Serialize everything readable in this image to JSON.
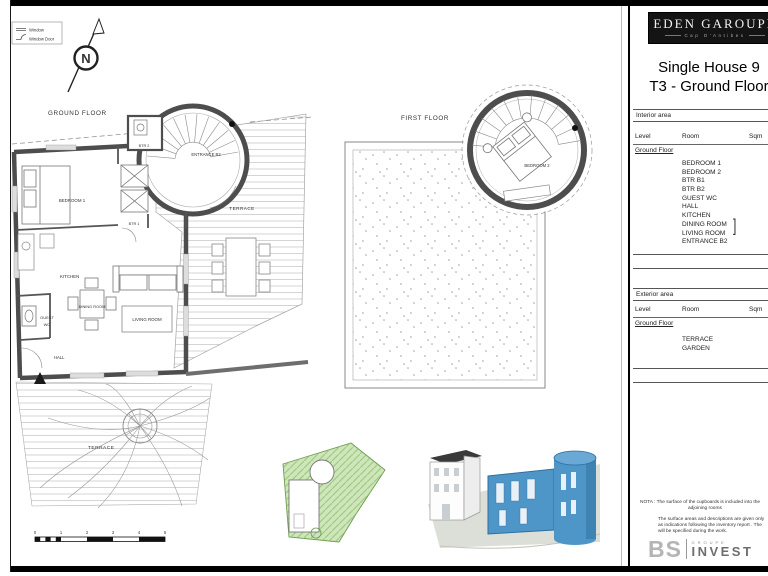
{
  "sheet": {
    "legend": {
      "window": "Window",
      "window_door": "Window Door"
    },
    "north_label": "N",
    "ground": {
      "title": "GROUND FLOOR",
      "rooms": {
        "bedroom1": "BEDROOM 1",
        "btr2": "BTR 2",
        "btr1": "BTR 1",
        "entrance_b2": "ENTRANCE B2",
        "kitchen": "KITCHEN",
        "dining": "DINING ROOM",
        "living": "LIVING ROOM",
        "guest_wc1": "GUEST",
        "guest_wc2": "WC",
        "hall": "HALL",
        "terrace_upper": "TERRACE",
        "terrace_lower": "TERRACE"
      }
    },
    "first": {
      "title": "FIRST FLOOR",
      "rooms": {
        "bedroom2": "BEDROOM 2"
      }
    },
    "scale_ticks": [
      "0",
      "1",
      "2",
      "3",
      "4",
      "5"
    ]
  },
  "panel": {
    "brand": {
      "name": "EDEN GAROUPE",
      "tagline": "Cap D'Antibes"
    },
    "title": {
      "line1": "Single House 9",
      "line2": "T3 - Ground Floor"
    },
    "interior": {
      "heading": "Interior area",
      "columns": {
        "level": "Level",
        "room": "Room",
        "sqm": "Sqm"
      },
      "level": "Ground Floor",
      "rows": [
        {
          "room": "BEDROOM 1",
          "sqm": "14.25 m²"
        },
        {
          "room": "BEDROOM 2",
          "sqm": "12.15 m²"
        },
        {
          "room": "BTR B1",
          "sqm": "2.40 m²"
        },
        {
          "room": "BTR B2",
          "sqm": "3.40 m²"
        },
        {
          "room": "GUEST WC",
          "sqm": "1.30 m²"
        },
        {
          "room": "HALL",
          "sqm": "2.40 m²"
        },
        {
          "room": "KITCHEN",
          "sqm": "6.10 m²"
        }
      ],
      "combined": {
        "room_line1": "DINING ROOM",
        "room_line2": "LIVING ROOM",
        "bracket": "]",
        "sqm": "22.70 m²"
      },
      "last": {
        "room": "ENTRANCE B2",
        "sqm": "13.10 m²"
      },
      "total": "77.80 m²"
    },
    "exterior": {
      "heading": "Exterior area",
      "columns": {
        "level": "Level",
        "room": "Room",
        "sqm": "Sqm"
      },
      "level": "Ground Floor",
      "rows": [
        {
          "room": "TERRACE",
          "sqm": "65.50 m²"
        },
        {
          "room": "GARDEN",
          "sqm": "87.20 m²"
        }
      ],
      "total": "152.70 m²"
    },
    "nota": [
      "NOTA : The surface of the cupboards is included into the",
      "adjoining rooms",
      "The surface areas and descriptions are given only",
      "as indications following the inventory report . The",
      "will be specified during the work."
    ],
    "footer": {
      "bs": "BS",
      "groupe": "GROUPE",
      "invest": "INVEST"
    }
  },
  "colors": {
    "wall": "#4d4d4d",
    "blue_building": "#4f96c8",
    "site_green": "#cfe6ba"
  }
}
